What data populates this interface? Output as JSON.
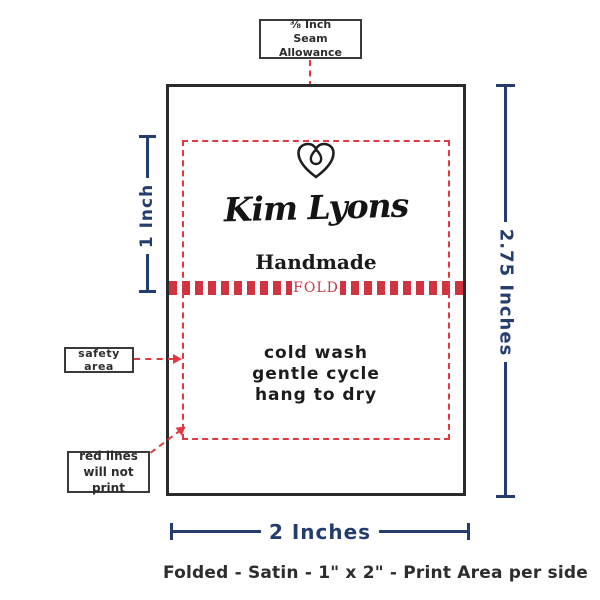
{
  "colors": {
    "navy": "#253d6e",
    "red": "#e03a40",
    "ink": "#2d2d2d"
  },
  "seam_callout": {
    "line1": "⅜ Inch",
    "line2": "Seam Allowance"
  },
  "tag": {
    "brand_name": "Kim Lyons",
    "subtitle": "Handmade",
    "fold": "FOLD",
    "care_lines": [
      "cold wash",
      "gentle cycle",
      "hang to dry"
    ]
  },
  "dimensions": {
    "print_height": "1 Inch",
    "total_height": "2.75 Inches",
    "width": "2 Inches"
  },
  "callouts": {
    "safety_area": "safety area",
    "red_lines": [
      "red lines",
      "will not print"
    ]
  },
  "footer_caption": "Folded - Satin - 1\" x 2\" - Print Area per side"
}
